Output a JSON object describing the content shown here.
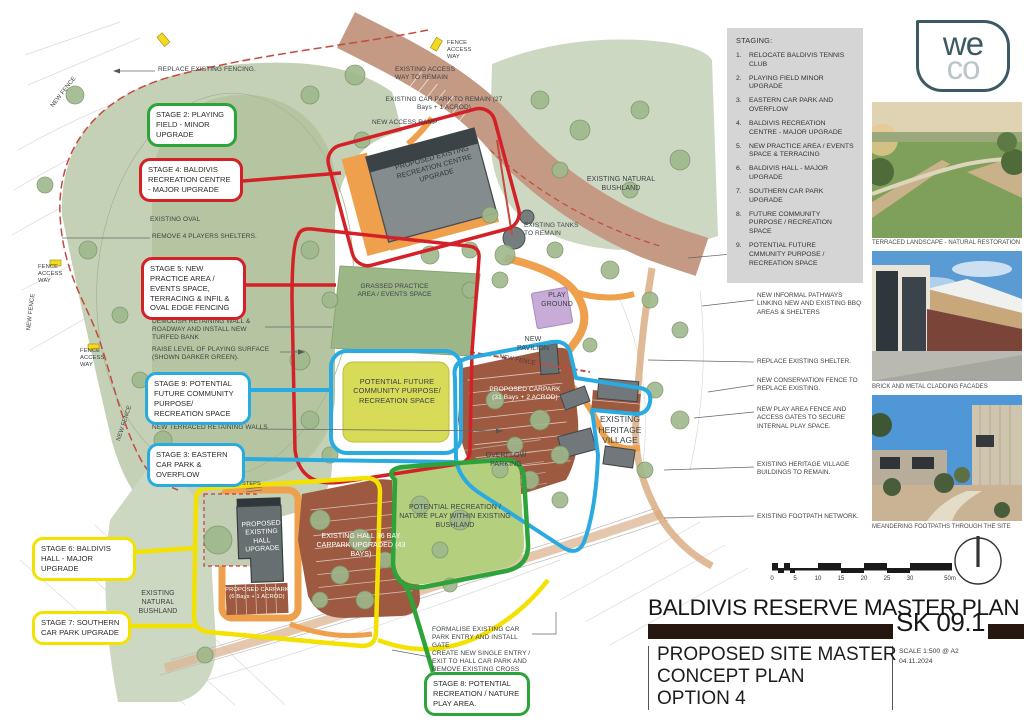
{
  "colors": {
    "stage_green": "#2ca43a",
    "stage_red": "#d42027",
    "stage_blue": "#29abe2",
    "stage_yellow": "#f3e100",
    "title_bar": "#271711",
    "panel_grey": "#d5d5d5",
    "oval_green": "#c5d1b6",
    "carpark_brown": "#9d5a41",
    "path_orange": "#efa04d",
    "accessway_rose": "#c49a85",
    "playground_purple": "#c8abd6"
  },
  "logo": {
    "we": "we",
    "co": "co"
  },
  "staging": {
    "heading": "STAGING:",
    "items": [
      "RELOCATE BALDIVIS TENNIS CLUB",
      "PLAYING FIELD MINOR UPGRADE",
      "EASTERN CAR PARK AND OVERFLOW",
      "BALDIVIS RECREATION CENTRE - MAJOR UPGRADE",
      "NEW PRACTICE AREA / EVENTS SPACE & TERRACING",
      "BALDIVIS HALL - MAJOR UPGRADE",
      "SOUTHERN CAR PARK UPGRADE",
      "FUTURE COMMUNITY PURPOSE / RECREATION SPACE",
      "POTENTIAL FUTURE CMMUNITY PURPOSE / RECREATION SPACE"
    ]
  },
  "stages": {
    "s2": "STAGE 2: PLAYING FIELD - MINOR UPGRADE",
    "s3": "STAGE 3: EASTERN CAR PARK & OVERFLOW",
    "s4": "STAGE 4: BALDIVIS RECREATION CENTRE - MAJOR UPGRADE",
    "s5": "STAGE 5: NEW PRACTICE AREA / EVENTS SPACE, TERRACING & INFIL & OVAL EDGE FENCING",
    "s6": "STAGE 6: BALDIVIS HALL - MAJOR UPGRADE",
    "s7": "STAGE 7: SOUTHERN CAR PARK UPGRADE",
    "s8": "STAGE 8: POTENTIAL RECREATION / NATURE PLAY AREA.",
    "s9": "STAGE 9: POTENTIAL FUTURE COMMUNITY PURPOSE/ RECREATION SPACE"
  },
  "plan": {
    "labels": {
      "existing_oval": "EXISTING OVAL",
      "remove_shelters": "REMOVE 4 PLAYERS SHELTERS.",
      "demolish_wall": "DEMOLISH RETAINING WALL & ROADWAY AND INSTALL NEW TURFED BANK",
      "raise_level": "RAISE LEVEL OF PLAYING SURFACE (SHOWN DARKER GREEN).",
      "terraced_walls": "NEW TERRACED RETAINING WALLS",
      "access_way_remain": "EXISTING ACCESS WAY TO REMAIN",
      "car_park_remain": "EXISTING CAR PARK TO REMAIN (27 Bays + 1 ACROD)",
      "new_access_ramp": "NEW ACCESS RAMP",
      "rec_centre": "PROPOSED EXISTING RECREATION CENTRE UPGRADE",
      "bushland_ne": "EXISTING NATURAL BUSHLAND",
      "tanks": "EXISTING TANKS TO REMAIN",
      "practice_area": "GRASSED PRACTICE AREA / EVENTS SPACE",
      "playground": "PLAY GROUND",
      "pavilion": "NEW PAVILION",
      "new_fence": "NEW FENCE",
      "potential_future": "POTENTIAL FUTURE COMMUNITY PURPOSE/ RECREATION SPACE",
      "proposed_carpark": "PROPOSED CARPARK (31 Bays + 2 ACROD)",
      "overflow": "OVERFLOW PARKING",
      "heritage": "EXISTING HERITAGE VILLAGE",
      "hall_carpark": "EXISTING HALL 36 BAY CARPARK UPGRADED (43 BAYS)",
      "hall": "PROPOSED EXISTING HALL UPGRADE",
      "hall_carpark_small": "PROPOSED CARPARK (6 Bays + 1 ACROD)",
      "nature_play": "POTENTIAL RECREATION / NATURE PLAY WITHIN EXISTING BUSHLAND",
      "bushland_sw": "EXISTING NATURAL BUSHLAND",
      "steps": "STEPS",
      "fence_access": "FENCE ACCESS WAY",
      "replace_fencing": "REPLACE EXISTING FENCING.",
      "formalise": "FORMALISE EXISTING CAR PARK ENTRY AND INSTALL GATE",
      "new_entry": "CREATE NEW SINGLE ENTRY / EXIT TO HALL CAR PARK AND REMOVE EXISTING CROSS OVERS"
    },
    "notes_right": [
      "EXISTING RECREATION CENTRE NORTH CARPARK ACCESS TO REMAIN",
      "NEW INFORMAL PATHWAYS LINKING NEW AND EXISTING BBQ AREAS & SHELTERS",
      "REPLACE EXISTING SHELTER.",
      "NEW CONSERVATION FENCE TO REPLACE EXISTING.",
      "NEW PLAY AREA FENCE AND ACCESS GATES TO SECURE INTERNAL PLAY SPACE.",
      "EXISTING HERITAGE VILLAGE BUILDINGS TO REMAIN.",
      "EXISTING FOOTPATH NETWORK."
    ]
  },
  "photos": [
    {
      "caption": "TERRACED LANDSCAPE - NATURAL RESTORATION"
    },
    {
      "caption": "BRICK AND METAL CLADDING FACADES"
    },
    {
      "caption": "MEANDERING FOOTPATHS THROUGH THE SITE"
    }
  ],
  "scalebar": {
    "ticks": [
      "0",
      "5",
      "10",
      "15",
      "20",
      "25",
      "30",
      "50m"
    ]
  },
  "title_block": {
    "project": "BALDIVIS RESERVE MASTER PLAN",
    "sheet": "SK 09.1",
    "line1": "PROPOSED SITE MASTER",
    "line2": "CONCEPT PLAN",
    "line3": "OPTION 4",
    "scale": "SCALE 1:500 @ A2",
    "date": "04.11.2024"
  }
}
